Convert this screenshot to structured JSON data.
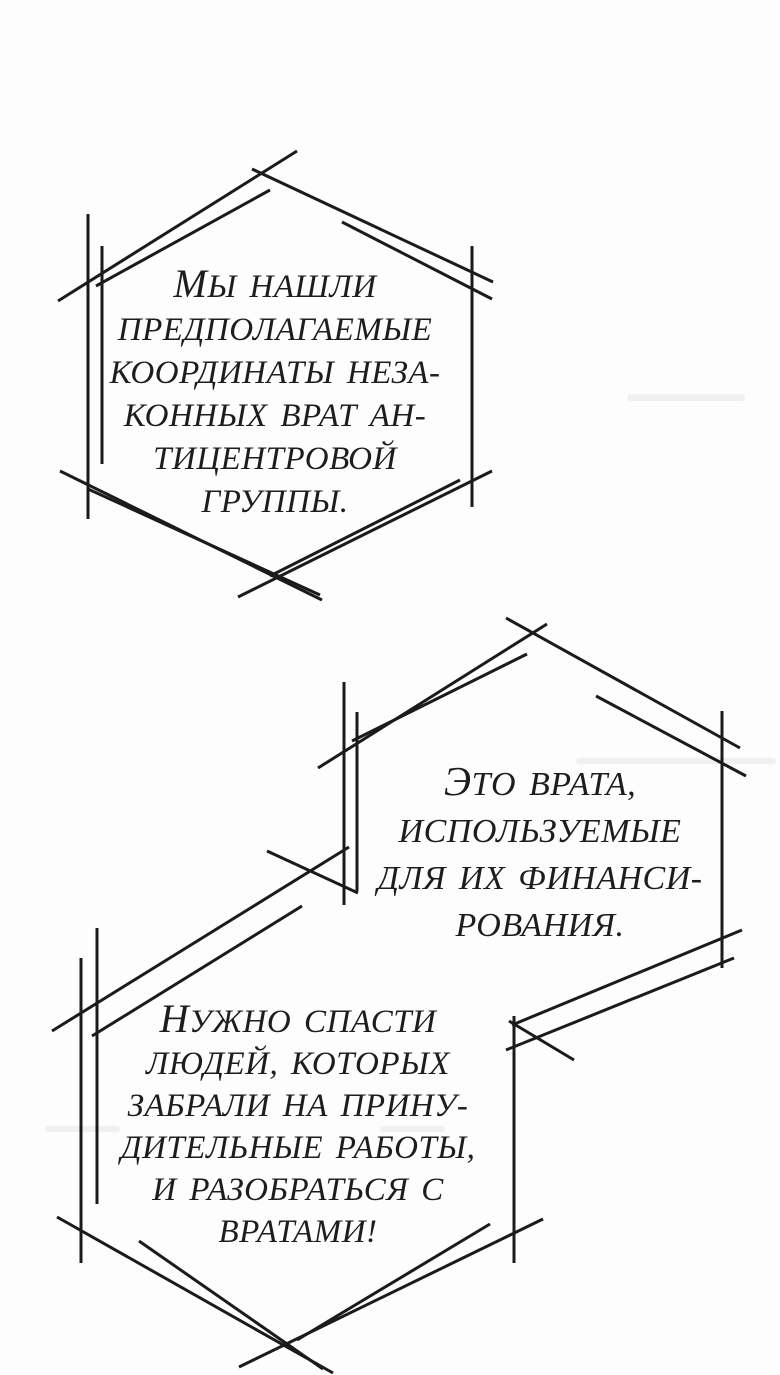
{
  "panel": {
    "type": "manga-page",
    "background": "#fdfdfd",
    "ink": "#1b1b1b",
    "bubbles": [
      {
        "name": "speech-bubble-1",
        "shape": "sketched-hexagon",
        "lines": [
          "МЫ НАШЛИ",
          "ПРЕДПОЛАГАЕМЫЕ",
          "КООРДИНАТЫ НЕЗА-",
          "КОННЫХ ВРАТ АН-",
          "ТИЦЕНТРОВОЙ",
          "ГРУППЫ."
        ]
      },
      {
        "name": "speech-bubble-2",
        "shape": "sketched-hexagon",
        "lines": [
          "ЭТО ВРАТА,",
          "ИСПОЛЬЗУЕМЫЕ",
          "ДЛЯ ИХ ФИНАНСИ-",
          "РОВАНИЯ."
        ]
      },
      {
        "name": "speech-bubble-3",
        "shape": "sketched-hexagon",
        "lines": [
          "НУЖНО СПАСТИ",
          "ЛЮДЕЙ, КОТОРЫХ",
          "ЗАБРАЛИ НА ПРИНУ-",
          "ДИТЕЛЬНЫЕ РАБОТЫ,",
          "И РАЗОБРАТЬСЯ С",
          "ВРАТАМИ!"
        ]
      }
    ]
  }
}
